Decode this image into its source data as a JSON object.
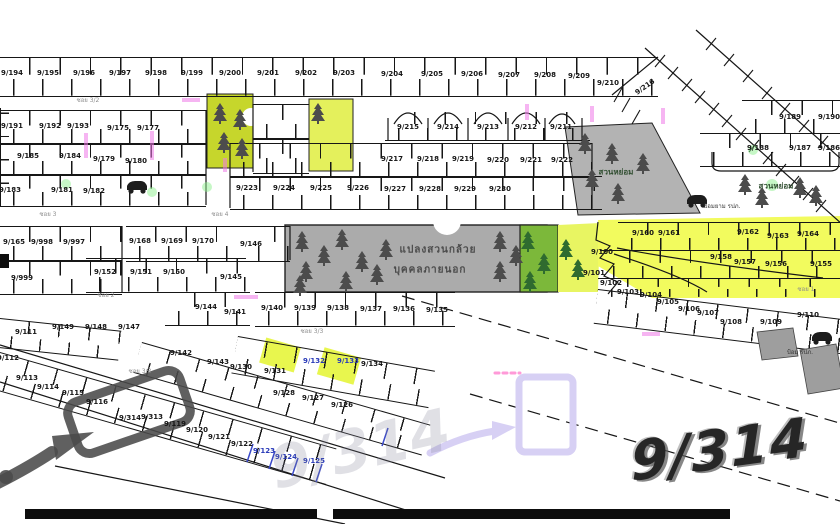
{
  "big": {
    "main": "9/314",
    "watermark": "9/314"
  },
  "colors": {
    "plot_line": "#161616",
    "yellow_highlight": "#f2fb5e",
    "yellow_green_block": "#c6d62c",
    "green_section": "#7cb83a",
    "gray_garden": "#ababab",
    "marker_gray": "#4a4a4a",
    "lavender_annotation": "#d7d0f4",
    "blue_pen": "#2839b8",
    "magenta_mark": "#f07ae8"
  },
  "labels": [
    {
      "t": "9/194",
      "x": 12,
      "y": 73,
      "k": "p"
    },
    {
      "t": "9/195",
      "x": 48,
      "y": 73,
      "k": "p"
    },
    {
      "t": "9/196",
      "x": 84,
      "y": 73,
      "k": "p"
    },
    {
      "t": "9/197",
      "x": 120,
      "y": 73,
      "k": "p"
    },
    {
      "t": "9/198",
      "x": 156,
      "y": 73,
      "k": "p"
    },
    {
      "t": "9/199",
      "x": 192,
      "y": 73,
      "k": "p"
    },
    {
      "t": "9/200",
      "x": 230,
      "y": 73,
      "k": "p"
    },
    {
      "t": "9/201",
      "x": 268,
      "y": 73,
      "k": "p"
    },
    {
      "t": "9/202",
      "x": 306,
      "y": 73,
      "k": "p"
    },
    {
      "t": "9/203",
      "x": 344,
      "y": 73,
      "k": "p"
    },
    {
      "t": "9/204",
      "x": 392,
      "y": 74,
      "k": "p"
    },
    {
      "t": "9/205",
      "x": 432,
      "y": 74,
      "k": "p"
    },
    {
      "t": "9/206",
      "x": 472,
      "y": 74,
      "k": "p"
    },
    {
      "t": "9/207",
      "x": 509,
      "y": 75,
      "k": "p"
    },
    {
      "t": "9/208",
      "x": 545,
      "y": 75,
      "k": "p"
    },
    {
      "t": "9/209",
      "x": 579,
      "y": 76,
      "k": "p"
    },
    {
      "t": "9/210",
      "x": 608,
      "y": 83,
      "k": "p"
    },
    {
      "t": "9/216",
      "x": 645,
      "y": 87,
      "k": "p",
      "r": -35
    },
    {
      "t": "9/215",
      "x": 408,
      "y": 127,
      "k": "p"
    },
    {
      "t": "9/214",
      "x": 448,
      "y": 127,
      "k": "p"
    },
    {
      "t": "9/213",
      "x": 488,
      "y": 127,
      "k": "p"
    },
    {
      "t": "9/212",
      "x": 526,
      "y": 127,
      "k": "p"
    },
    {
      "t": "9/211",
      "x": 561,
      "y": 127,
      "k": "p"
    },
    {
      "t": "9/217",
      "x": 392,
      "y": 159,
      "k": "p"
    },
    {
      "t": "9/218",
      "x": 428,
      "y": 159,
      "k": "p"
    },
    {
      "t": "9/219",
      "x": 463,
      "y": 159,
      "k": "p"
    },
    {
      "t": "9/220",
      "x": 498,
      "y": 160,
      "k": "p"
    },
    {
      "t": "9/221",
      "x": 531,
      "y": 160,
      "k": "p"
    },
    {
      "t": "9/222",
      "x": 562,
      "y": 160,
      "k": "p"
    },
    {
      "t": "9/223",
      "x": 247,
      "y": 188,
      "k": "p"
    },
    {
      "t": "9/224",
      "x": 284,
      "y": 188,
      "k": "p"
    },
    {
      "t": "9/225",
      "x": 321,
      "y": 188,
      "k": "p"
    },
    {
      "t": "9/226",
      "x": 358,
      "y": 188,
      "k": "p"
    },
    {
      "t": "9/227",
      "x": 395,
      "y": 189,
      "k": "p"
    },
    {
      "t": "9/228",
      "x": 430,
      "y": 189,
      "k": "p"
    },
    {
      "t": "9/229",
      "x": 465,
      "y": 189,
      "k": "p"
    },
    {
      "t": "9/230",
      "x": 500,
      "y": 189,
      "k": "p"
    },
    {
      "t": "9/191",
      "x": 12,
      "y": 126,
      "k": "p"
    },
    {
      "t": "9/192",
      "x": 50,
      "y": 126,
      "k": "p"
    },
    {
      "t": "9/193",
      "x": 78,
      "y": 126,
      "k": "p"
    },
    {
      "t": "9/175",
      "x": 118,
      "y": 128,
      "k": "p"
    },
    {
      "t": "9/177",
      "x": 148,
      "y": 128,
      "k": "p"
    },
    {
      "t": "9/185",
      "x": 28,
      "y": 156,
      "k": "p"
    },
    {
      "t": "9/184",
      "x": 70,
      "y": 156,
      "k": "p"
    },
    {
      "t": "9/179",
      "x": 104,
      "y": 159,
      "k": "p"
    },
    {
      "t": "9/180",
      "x": 136,
      "y": 161,
      "k": "p"
    },
    {
      "t": "9/183",
      "x": 10,
      "y": 190,
      "k": "p"
    },
    {
      "t": "9/181",
      "x": 62,
      "y": 190,
      "k": "p"
    },
    {
      "t": "9/182",
      "x": 94,
      "y": 191,
      "k": "p"
    },
    {
      "t": "9/165",
      "x": 14,
      "y": 242,
      "k": "p"
    },
    {
      "t": "9/998",
      "x": 42,
      "y": 242,
      "k": "p"
    },
    {
      "t": "9/997",
      "x": 74,
      "y": 242,
      "k": "p"
    },
    {
      "t": "9/999",
      "x": 22,
      "y": 278,
      "k": "p"
    },
    {
      "t": "9/168",
      "x": 140,
      "y": 241,
      "k": "p"
    },
    {
      "t": "9/169",
      "x": 172,
      "y": 241,
      "k": "p"
    },
    {
      "t": "9/170",
      "x": 203,
      "y": 241,
      "k": "p"
    },
    {
      "t": "9/152",
      "x": 105,
      "y": 272,
      "k": "p"
    },
    {
      "t": "9/151",
      "x": 141,
      "y": 272,
      "k": "p"
    },
    {
      "t": "9/150",
      "x": 174,
      "y": 272,
      "k": "p"
    },
    {
      "t": "9/146",
      "x": 251,
      "y": 244,
      "k": "p"
    },
    {
      "t": "9/145",
      "x": 231,
      "y": 277,
      "k": "p"
    },
    {
      "t": "9/144",
      "x": 206,
      "y": 307,
      "k": "p"
    },
    {
      "t": "9/149",
      "x": 63,
      "y": 327,
      "k": "p"
    },
    {
      "t": "9/148",
      "x": 96,
      "y": 327,
      "k": "p"
    },
    {
      "t": "9/147",
      "x": 129,
      "y": 327,
      "k": "p"
    },
    {
      "t": "9/111",
      "x": 26,
      "y": 332,
      "k": "p"
    },
    {
      "t": "9/141",
      "x": 235,
      "y": 312,
      "k": "p"
    },
    {
      "t": "9/142",
      "x": 181,
      "y": 353,
      "k": "p"
    },
    {
      "t": "9/143",
      "x": 218,
      "y": 362,
      "k": "p"
    },
    {
      "t": "9/140",
      "x": 272,
      "y": 308,
      "k": "p"
    },
    {
      "t": "9/139",
      "x": 305,
      "y": 308,
      "k": "p"
    },
    {
      "t": "9/138",
      "x": 338,
      "y": 308,
      "k": "p"
    },
    {
      "t": "9/137",
      "x": 371,
      "y": 309,
      "k": "p"
    },
    {
      "t": "9/136",
      "x": 404,
      "y": 309,
      "k": "p"
    },
    {
      "t": "9/135",
      "x": 437,
      "y": 310,
      "k": "p"
    },
    {
      "t": "9/112",
      "x": 8,
      "y": 358,
      "k": "p"
    },
    {
      "t": "9/113",
      "x": 27,
      "y": 378,
      "k": "p"
    },
    {
      "t": "9/114",
      "x": 48,
      "y": 387,
      "k": "p"
    },
    {
      "t": "9/115",
      "x": 73,
      "y": 393,
      "k": "p"
    },
    {
      "t": "9/116",
      "x": 97,
      "y": 402,
      "k": "p"
    },
    {
      "t": "9/314",
      "x": 130,
      "y": 418,
      "k": "p"
    },
    {
      "t": "9/313",
      "x": 152,
      "y": 417,
      "k": "p"
    },
    {
      "t": "9/119",
      "x": 175,
      "y": 424,
      "k": "p"
    },
    {
      "t": "9/120",
      "x": 197,
      "y": 430,
      "k": "p"
    },
    {
      "t": "9/121",
      "x": 219,
      "y": 437,
      "k": "p"
    },
    {
      "t": "9/122",
      "x": 242,
      "y": 444,
      "k": "p"
    },
    {
      "t": "9/123",
      "x": 264,
      "y": 451,
      "k": "pb"
    },
    {
      "t": "9/124",
      "x": 286,
      "y": 457,
      "k": "pb"
    },
    {
      "t": "9/125",
      "x": 314,
      "y": 461,
      "k": "pb"
    },
    {
      "t": "9/130",
      "x": 241,
      "y": 367,
      "k": "p"
    },
    {
      "t": "9/131",
      "x": 275,
      "y": 371,
      "k": "p"
    },
    {
      "t": "9/132",
      "x": 314,
      "y": 361,
      "k": "pb"
    },
    {
      "t": "9/133",
      "x": 348,
      "y": 361,
      "k": "pb"
    },
    {
      "t": "9/134",
      "x": 372,
      "y": 364,
      "k": "p"
    },
    {
      "t": "9/128",
      "x": 284,
      "y": 393,
      "k": "p"
    },
    {
      "t": "9/127",
      "x": 313,
      "y": 398,
      "k": "p"
    },
    {
      "t": "9/126",
      "x": 342,
      "y": 405,
      "k": "p"
    },
    {
      "t": "9/160",
      "x": 643,
      "y": 233,
      "k": "p"
    },
    {
      "t": "9/161",
      "x": 669,
      "y": 233,
      "k": "p"
    },
    {
      "t": "9/162",
      "x": 748,
      "y": 232,
      "k": "p"
    },
    {
      "t": "9/163",
      "x": 778,
      "y": 236,
      "k": "p"
    },
    {
      "t": "9/164",
      "x": 808,
      "y": 234,
      "k": "p"
    },
    {
      "t": "9/158",
      "x": 721,
      "y": 257,
      "k": "p"
    },
    {
      "t": "9/157",
      "x": 745,
      "y": 262,
      "k": "p"
    },
    {
      "t": "9/156",
      "x": 776,
      "y": 264,
      "k": "p"
    },
    {
      "t": "9/155",
      "x": 821,
      "y": 264,
      "k": "p"
    },
    {
      "t": "9/100",
      "x": 602,
      "y": 252,
      "k": "p"
    },
    {
      "t": "9/101",
      "x": 594,
      "y": 273,
      "k": "p"
    },
    {
      "t": "9/102",
      "x": 611,
      "y": 283,
      "k": "p"
    },
    {
      "t": "9/103",
      "x": 628,
      "y": 292,
      "k": "p"
    },
    {
      "t": "9/104",
      "x": 651,
      "y": 295,
      "k": "p"
    },
    {
      "t": "9/105",
      "x": 668,
      "y": 302,
      "k": "p"
    },
    {
      "t": "9/106",
      "x": 689,
      "y": 309,
      "k": "p"
    },
    {
      "t": "9/107",
      "x": 708,
      "y": 313,
      "k": "p"
    },
    {
      "t": "9/108",
      "x": 731,
      "y": 322,
      "k": "p"
    },
    {
      "t": "9/109",
      "x": 771,
      "y": 322,
      "k": "p"
    },
    {
      "t": "9/110",
      "x": 808,
      "y": 315,
      "k": "p"
    },
    {
      "t": "9/189",
      "x": 790,
      "y": 117,
      "k": "p"
    },
    {
      "t": "9/190",
      "x": 829,
      "y": 117,
      "k": "p"
    },
    {
      "t": "9/188",
      "x": 758,
      "y": 148,
      "k": "p"
    },
    {
      "t": "9/187",
      "x": 800,
      "y": 148,
      "k": "p"
    },
    {
      "t": "9/186",
      "x": 829,
      "y": 148,
      "k": "p"
    },
    {
      "t": "ซอย 3/2",
      "x": 88,
      "y": 100,
      "k": "rd"
    },
    {
      "t": "ซอย 3",
      "x": 48,
      "y": 214,
      "k": "rd"
    },
    {
      "t": "ซอย 4",
      "x": 220,
      "y": 214,
      "k": "rd"
    },
    {
      "t": "ซอย 2",
      "x": 106,
      "y": 295,
      "k": "rd"
    },
    {
      "t": "ซอย 3/3",
      "x": 312,
      "y": 331,
      "k": "rd"
    },
    {
      "t": "ซอย 3/3",
      "x": 140,
      "y": 371,
      "k": "rd"
    },
    {
      "t": "ซอย 1",
      "x": 806,
      "y": 289,
      "k": "rd"
    },
    {
      "t": "แปลงสวนกล้วย",
      "x": 438,
      "y": 250,
      "k": "arb"
    },
    {
      "t": "บุคคลภายนอก",
      "x": 430,
      "y": 270,
      "k": "arb"
    },
    {
      "t": "สวนหย่อม",
      "x": 616,
      "y": 172,
      "k": "ar"
    },
    {
      "t": "สวนหย่อม",
      "x": 776,
      "y": 186,
      "k": "ar"
    },
    {
      "t": "ป้อมยาม รปภ.",
      "x": 722,
      "y": 206,
      "k": "ars"
    },
    {
      "t": "ป้อม รปภ.",
      "x": 800,
      "y": 352,
      "k": "ars"
    }
  ]
}
